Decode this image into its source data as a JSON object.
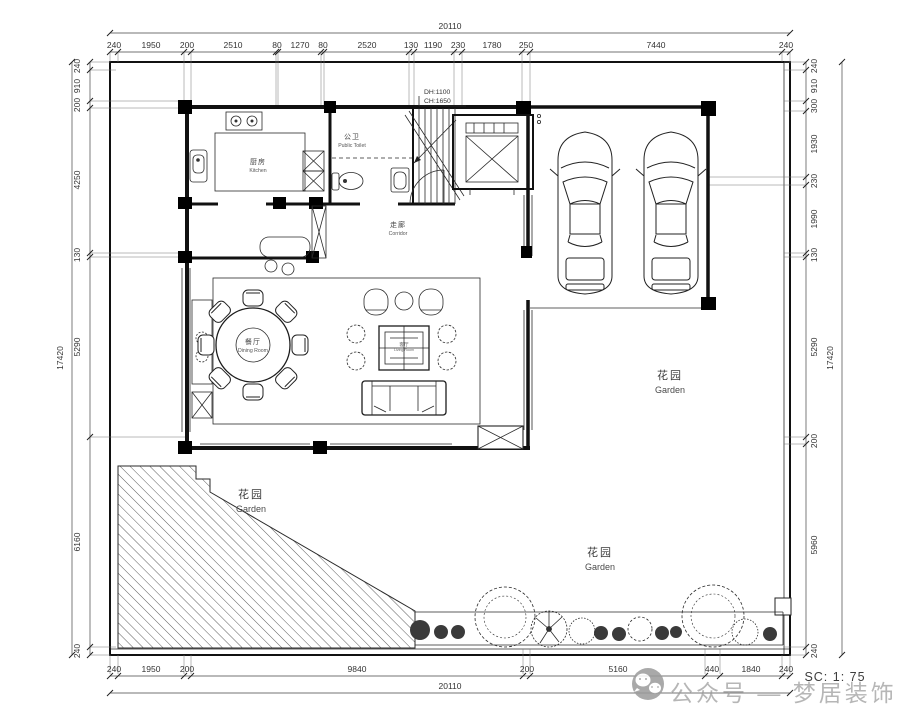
{
  "dims": {
    "top_total": "20110",
    "top": [
      "240",
      "1950",
      "200",
      "2510",
      "80",
      "1270",
      "80",
      "2520",
      "130",
      "1190",
      "230",
      "1780",
      "250",
      "7440",
      "240"
    ],
    "bottom_total": "20110",
    "bottom": [
      "240",
      "1950",
      "200",
      "9840",
      "200",
      "5160",
      "440",
      "1840",
      "240"
    ],
    "left_total": "17420",
    "left": [
      "240",
      "910",
      "200",
      "4250",
      "130",
      "5290",
      "6160",
      "240"
    ],
    "right_total": "17420",
    "right": [
      "240",
      "910",
      "300",
      "1930",
      "230",
      "1990",
      "130",
      "5290",
      "200",
      "5960",
      "240"
    ]
  },
  "rooms": {
    "kitchen_zh": "厨房",
    "kitchen_en": "Kitchen",
    "toilet_zh": "公卫",
    "toilet_en": "Public Toilet",
    "corridor_zh": "走廊",
    "corridor_en": "Corridor",
    "dining_zh": "餐厅",
    "dining_en": "Dining Room",
    "living_zh": "客厅",
    "living_en": "Living Room",
    "garden_zh": "花园",
    "garden_en": "Garden"
  },
  "stairs_note": {
    "dh": "DH:1100",
    "ch": "CH:1650"
  },
  "scale_label": "SC: 1: 75",
  "watermark_label": "公众号 — 梦居装饰",
  "colors": {
    "line": "#1c1c1c",
    "watermark": "#9b9b9b"
  }
}
